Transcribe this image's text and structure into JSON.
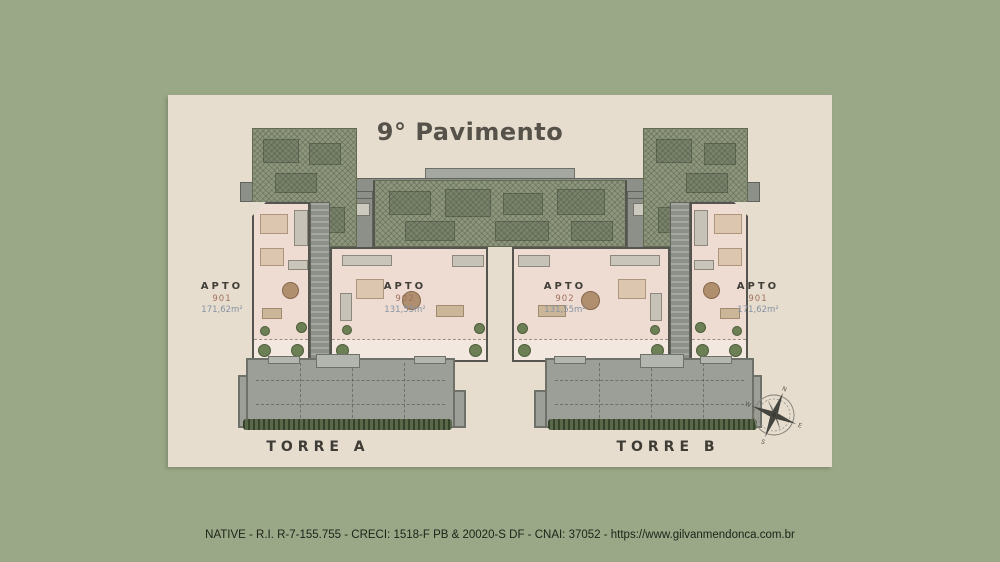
{
  "slide": {
    "background_color": "#9aa887",
    "panel_color": "#e6ddcf",
    "footer": "NATIVE - R.I. R-7-155.755 - CRECI: 1518-F PB & 20020-S DF - CNAI: 37052 - https://www.gilvanmendonca.com.br"
  },
  "plan": {
    "title": "9° Pavimento",
    "towers": [
      {
        "name": "TORRE A",
        "apartments": [
          {
            "label": "APTO",
            "number": "901",
            "area": "171,62m²"
          },
          {
            "label": "APTO",
            "number": "902",
            "area": "131,55m²"
          }
        ]
      },
      {
        "name": "TORRE B",
        "apartments": [
          {
            "label": "APTO",
            "number": "902",
            "area": "131,55m²"
          },
          {
            "label": "APTO",
            "number": "901",
            "area": "171,62m²"
          }
        ]
      }
    ],
    "compass": {
      "north": "N",
      "east": "E",
      "south": "S",
      "west": "W"
    },
    "colors": {
      "hatch_green": "#8e977d",
      "slab_gray": "#9b9f97",
      "interior_pink": "#eedcd3",
      "apto_number": "#a1705e",
      "apto_area": "#8592a1",
      "hedge_green": "#5a684a"
    }
  }
}
